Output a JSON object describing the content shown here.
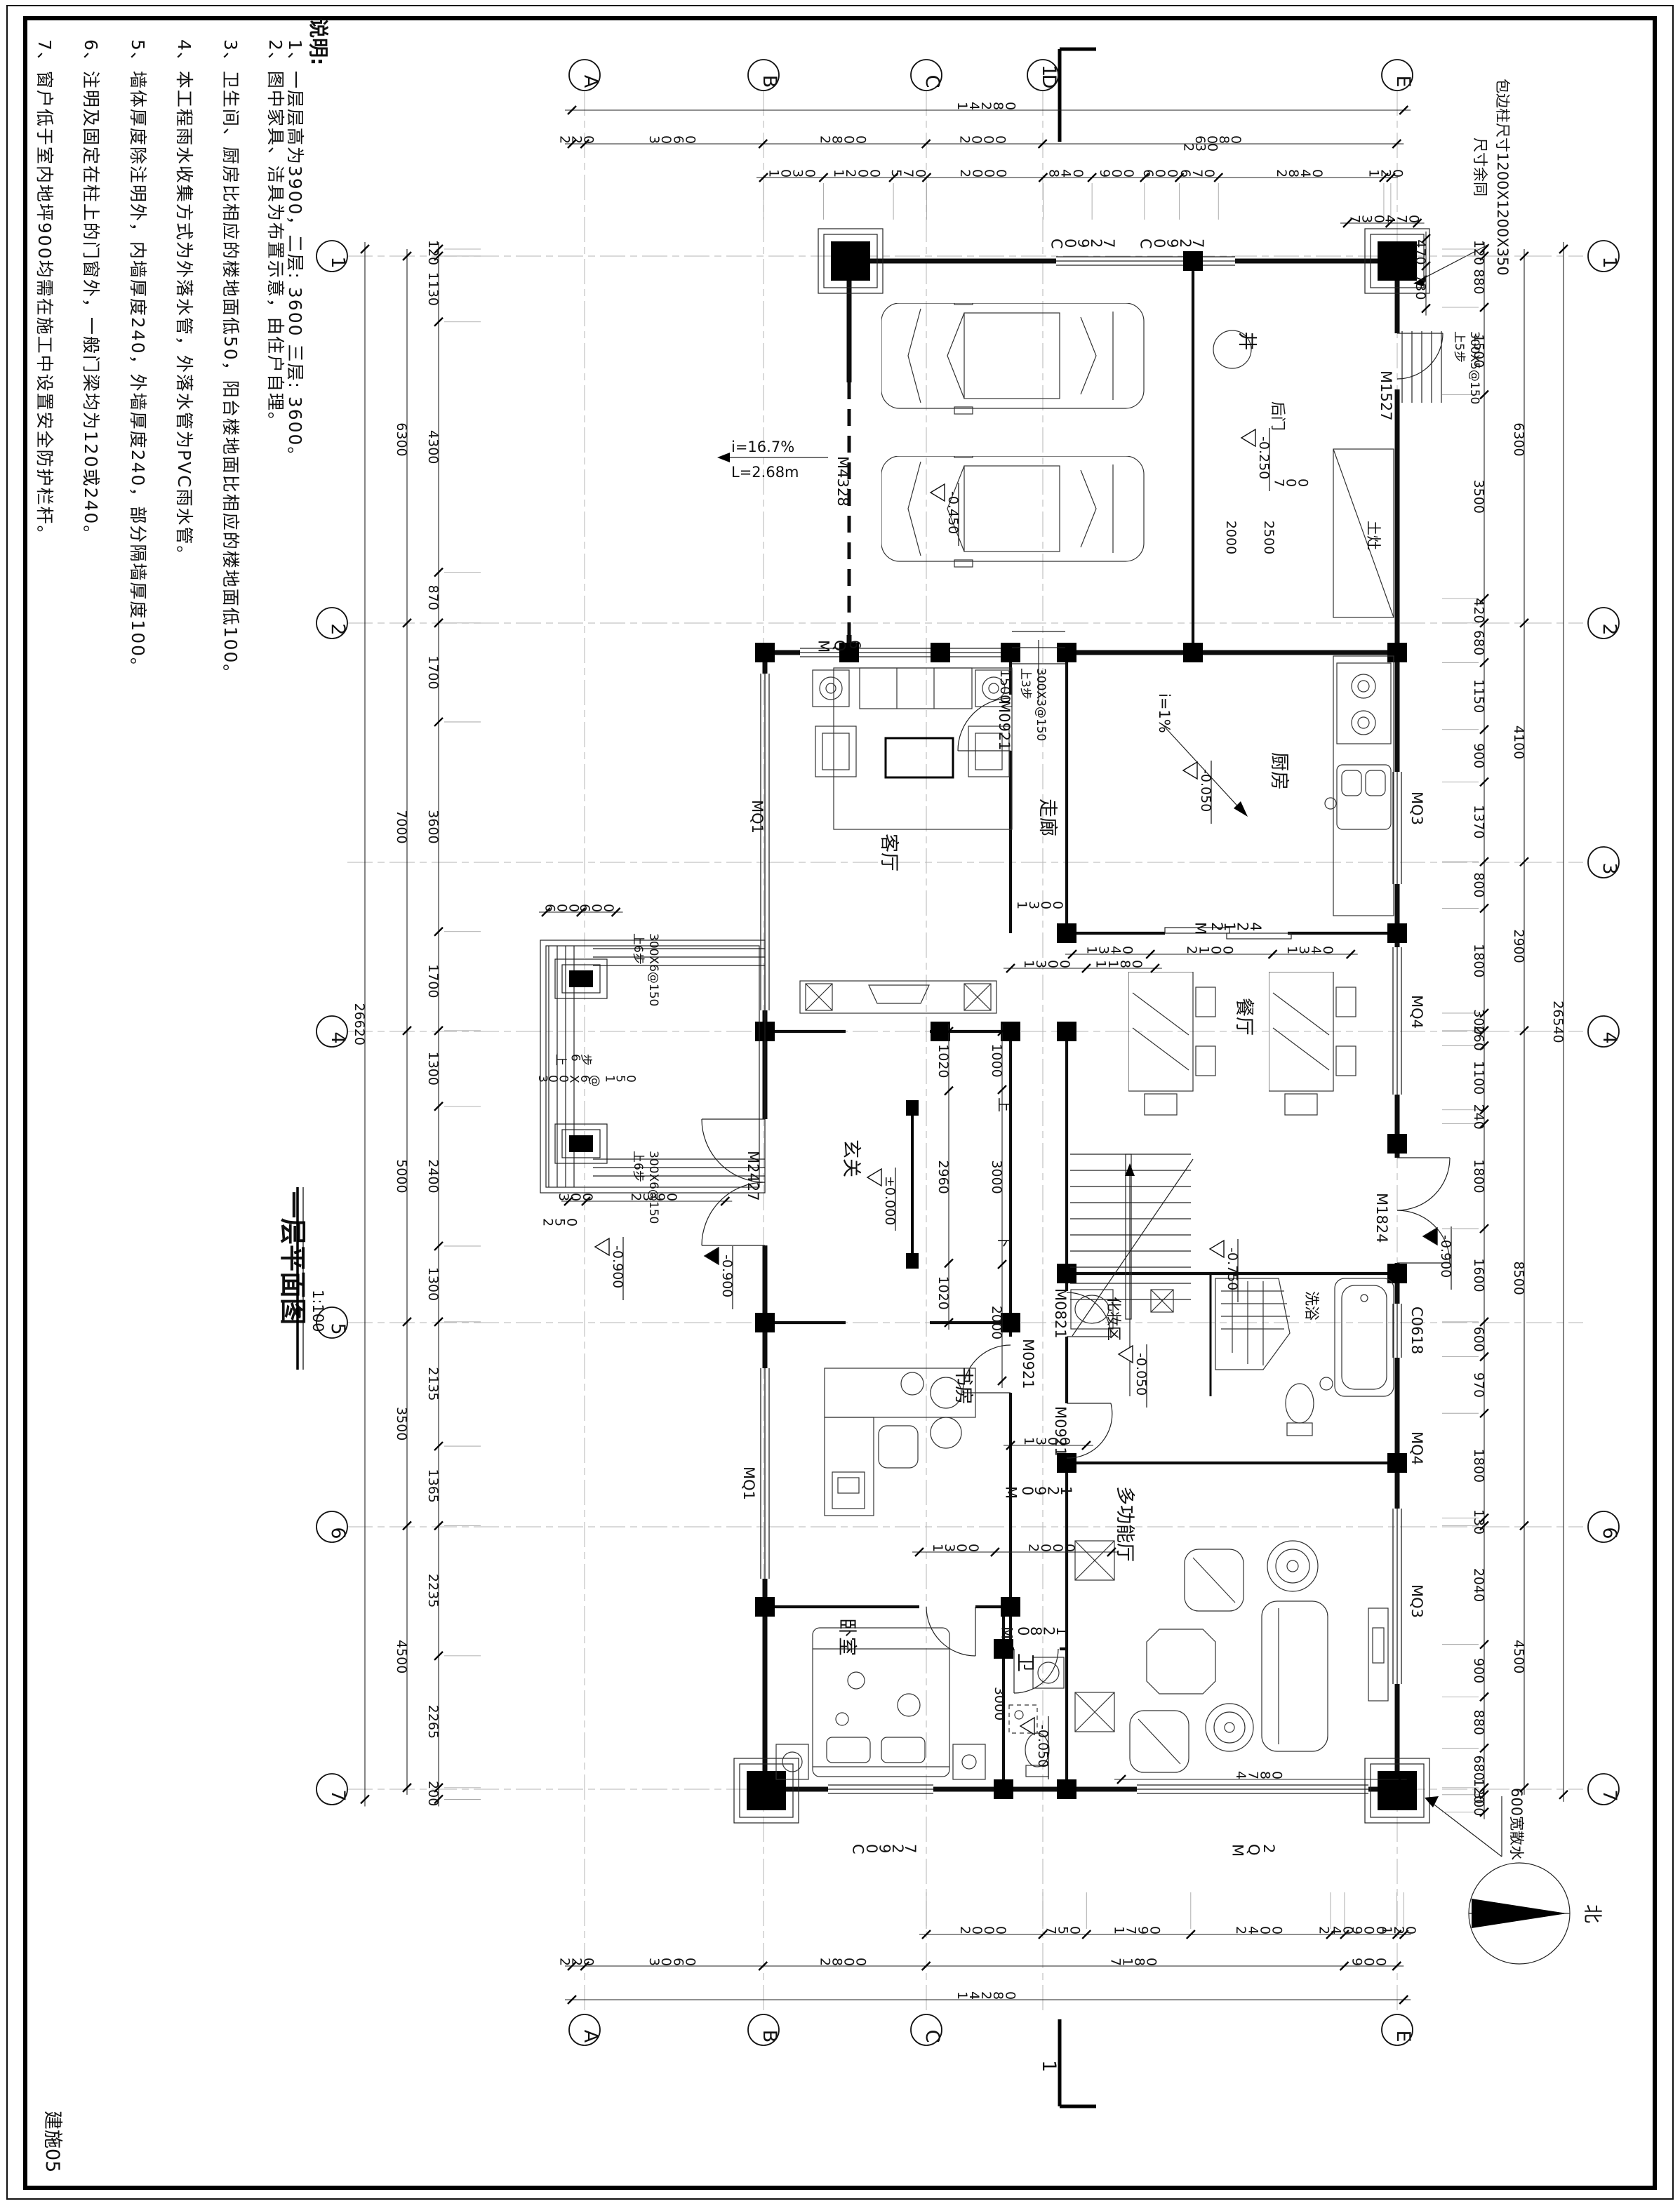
{
  "sheet": {
    "title": "一层平面图",
    "scale": "1:100",
    "number": "建施05"
  },
  "notes": {
    "header": "说明:",
    "items": [
      "1、一层层高为3900，二层: 3600 三层: 3600。",
      "2、图中家具、洁具为布置示意，由住户自理。",
      "3、卫生间、厨房比相应的楼地面低50，阳台楼地面比相应的楼地面低100。",
      "4、本工程雨水收集方式为外落水管，外落水管为PVC雨水管。",
      "5、墙体厚度除注明外，内墙厚度240，外墙厚度240，部分隔墙厚度100。",
      "6、注明及固定在柱上的门窗外，一般门梁均为120或240。",
      "7、窗户低于室内地坪900均需在施工中设置安全防护栏杆。"
    ]
  },
  "axes": {
    "letters": [
      "A",
      "B",
      "C",
      "D",
      "E"
    ],
    "numbers": [
      "1",
      "2",
      "3",
      "4",
      "5",
      "6",
      "7"
    ]
  },
  "dimensions": {
    "top": {
      "outer": [
        "14280"
      ],
      "mid": [
        "220",
        "3060",
        "2800",
        "2000",
        "6080"
      ],
      "inner": [
        "1030",
        "1200",
        "570",
        "2000",
        "840",
        "900",
        "600",
        "670",
        "2840",
        "120"
      ],
      "sub": "230"
    },
    "bottom": {
      "outer": [
        "14280"
      ],
      "mid": [
        "220",
        "3060",
        "2800",
        "7180",
        "900"
      ],
      "inner": [
        "2000",
        "750",
        "1790",
        "2400",
        "240",
        "900",
        "120"
      ]
    },
    "left": {
      "outer": [
        "26620"
      ],
      "mid": [
        "6300",
        "7000",
        "5000",
        "3500",
        "4500"
      ],
      "inner": [
        "120",
        "1130",
        "4300",
        "870",
        "1700",
        "3600",
        "1700",
        "1300",
        "2400",
        "1300",
        "2135",
        "1365",
        "2235",
        "2265",
        "200"
      ]
    },
    "right": {
      "outer": [
        "26540"
      ],
      "mid": [
        "6300",
        "4100",
        "2900",
        "8500",
        "4500"
      ],
      "inner": [
        "120",
        "880",
        "1500",
        "3500",
        "420",
        "680",
        "1150",
        "900",
        "1370",
        "800",
        "1800",
        "300",
        "260",
        "1100",
        "240",
        "1800",
        "1600",
        "600",
        "970",
        "1800",
        "130",
        "2040",
        "900",
        "880",
        "680",
        "120",
        "300"
      ]
    },
    "plan": {
      "kitchen": [
        "1340",
        "2100",
        "1340"
      ],
      "corridor": [
        "1300",
        "1180"
      ],
      "foyer_v": [
        "1020",
        "2960",
        "1020"
      ],
      "foyer_stair": [
        "1000",
        "3000",
        "2000"
      ],
      "study": [
        "1300",
        "2000"
      ],
      "study_door": [
        "1300"
      ],
      "porch": [
        "600",
        "600"
      ],
      "porch_s": [
        "300",
        "2390"
      ],
      "hall": [
        "4780"
      ],
      "corner_h": [
        "730",
        "470"
      ],
      "corner_v": [
        "470",
        "730"
      ]
    },
    "extra": {
      "d230": "230",
      "d250": "250",
      "d1500": "1500",
      "d1300": "1300",
      "d700": "700",
      "d2000": "2000",
      "d2500": "2500",
      "d3000": "3000"
    }
  },
  "rooms": {
    "living": "客厅",
    "kitchen": "厨房",
    "dining": "餐厅",
    "corridor": "走廊",
    "foyer": "玄关",
    "study": "书房",
    "bedroom": "卧室",
    "toilet": "卫",
    "hall": "多功能厅",
    "makeup": "化妆区",
    "bath": "洗浴"
  },
  "openings": {
    "c0927": "C0927",
    "c0618": "C0618",
    "mq1": "MQ1",
    "mq2": "MQ2",
    "mq3": "MQ3",
    "mq4": "MQ4",
    "mq6": "MQ6",
    "m4328": "M4328",
    "m2427": "M2427",
    "m2124": "M2124",
    "m1824": "M1824",
    "m1527": "M1527",
    "m0921": "M0921",
    "m0821": "M0821"
  },
  "levels": {
    "zero": "±0.000",
    "m050": "-0.050",
    "m250": "-0.250",
    "m450": "-0.450",
    "m750": "-0.750",
    "m900": "-0.900"
  },
  "annotations": {
    "ramp_slope": "i=16.7%",
    "ramp_len": "L=2.68m",
    "kitchen_slope": "i=1%",
    "corner_col_1": "包边柱尺寸1200X1200X350",
    "corner_col_2": "尺寸余同",
    "apron": "600宽散水",
    "well": "井",
    "back_door": "后门",
    "stove": "土灶",
    "north": "北",
    "up": "上",
    "down": "下",
    "section": "1"
  },
  "stairs": {
    "up6": "上6步",
    "r6": "300X6@150",
    "up5": "上5步",
    "r5": "300X5@150",
    "up3": "上3步",
    "r3": "300X3@150"
  }
}
